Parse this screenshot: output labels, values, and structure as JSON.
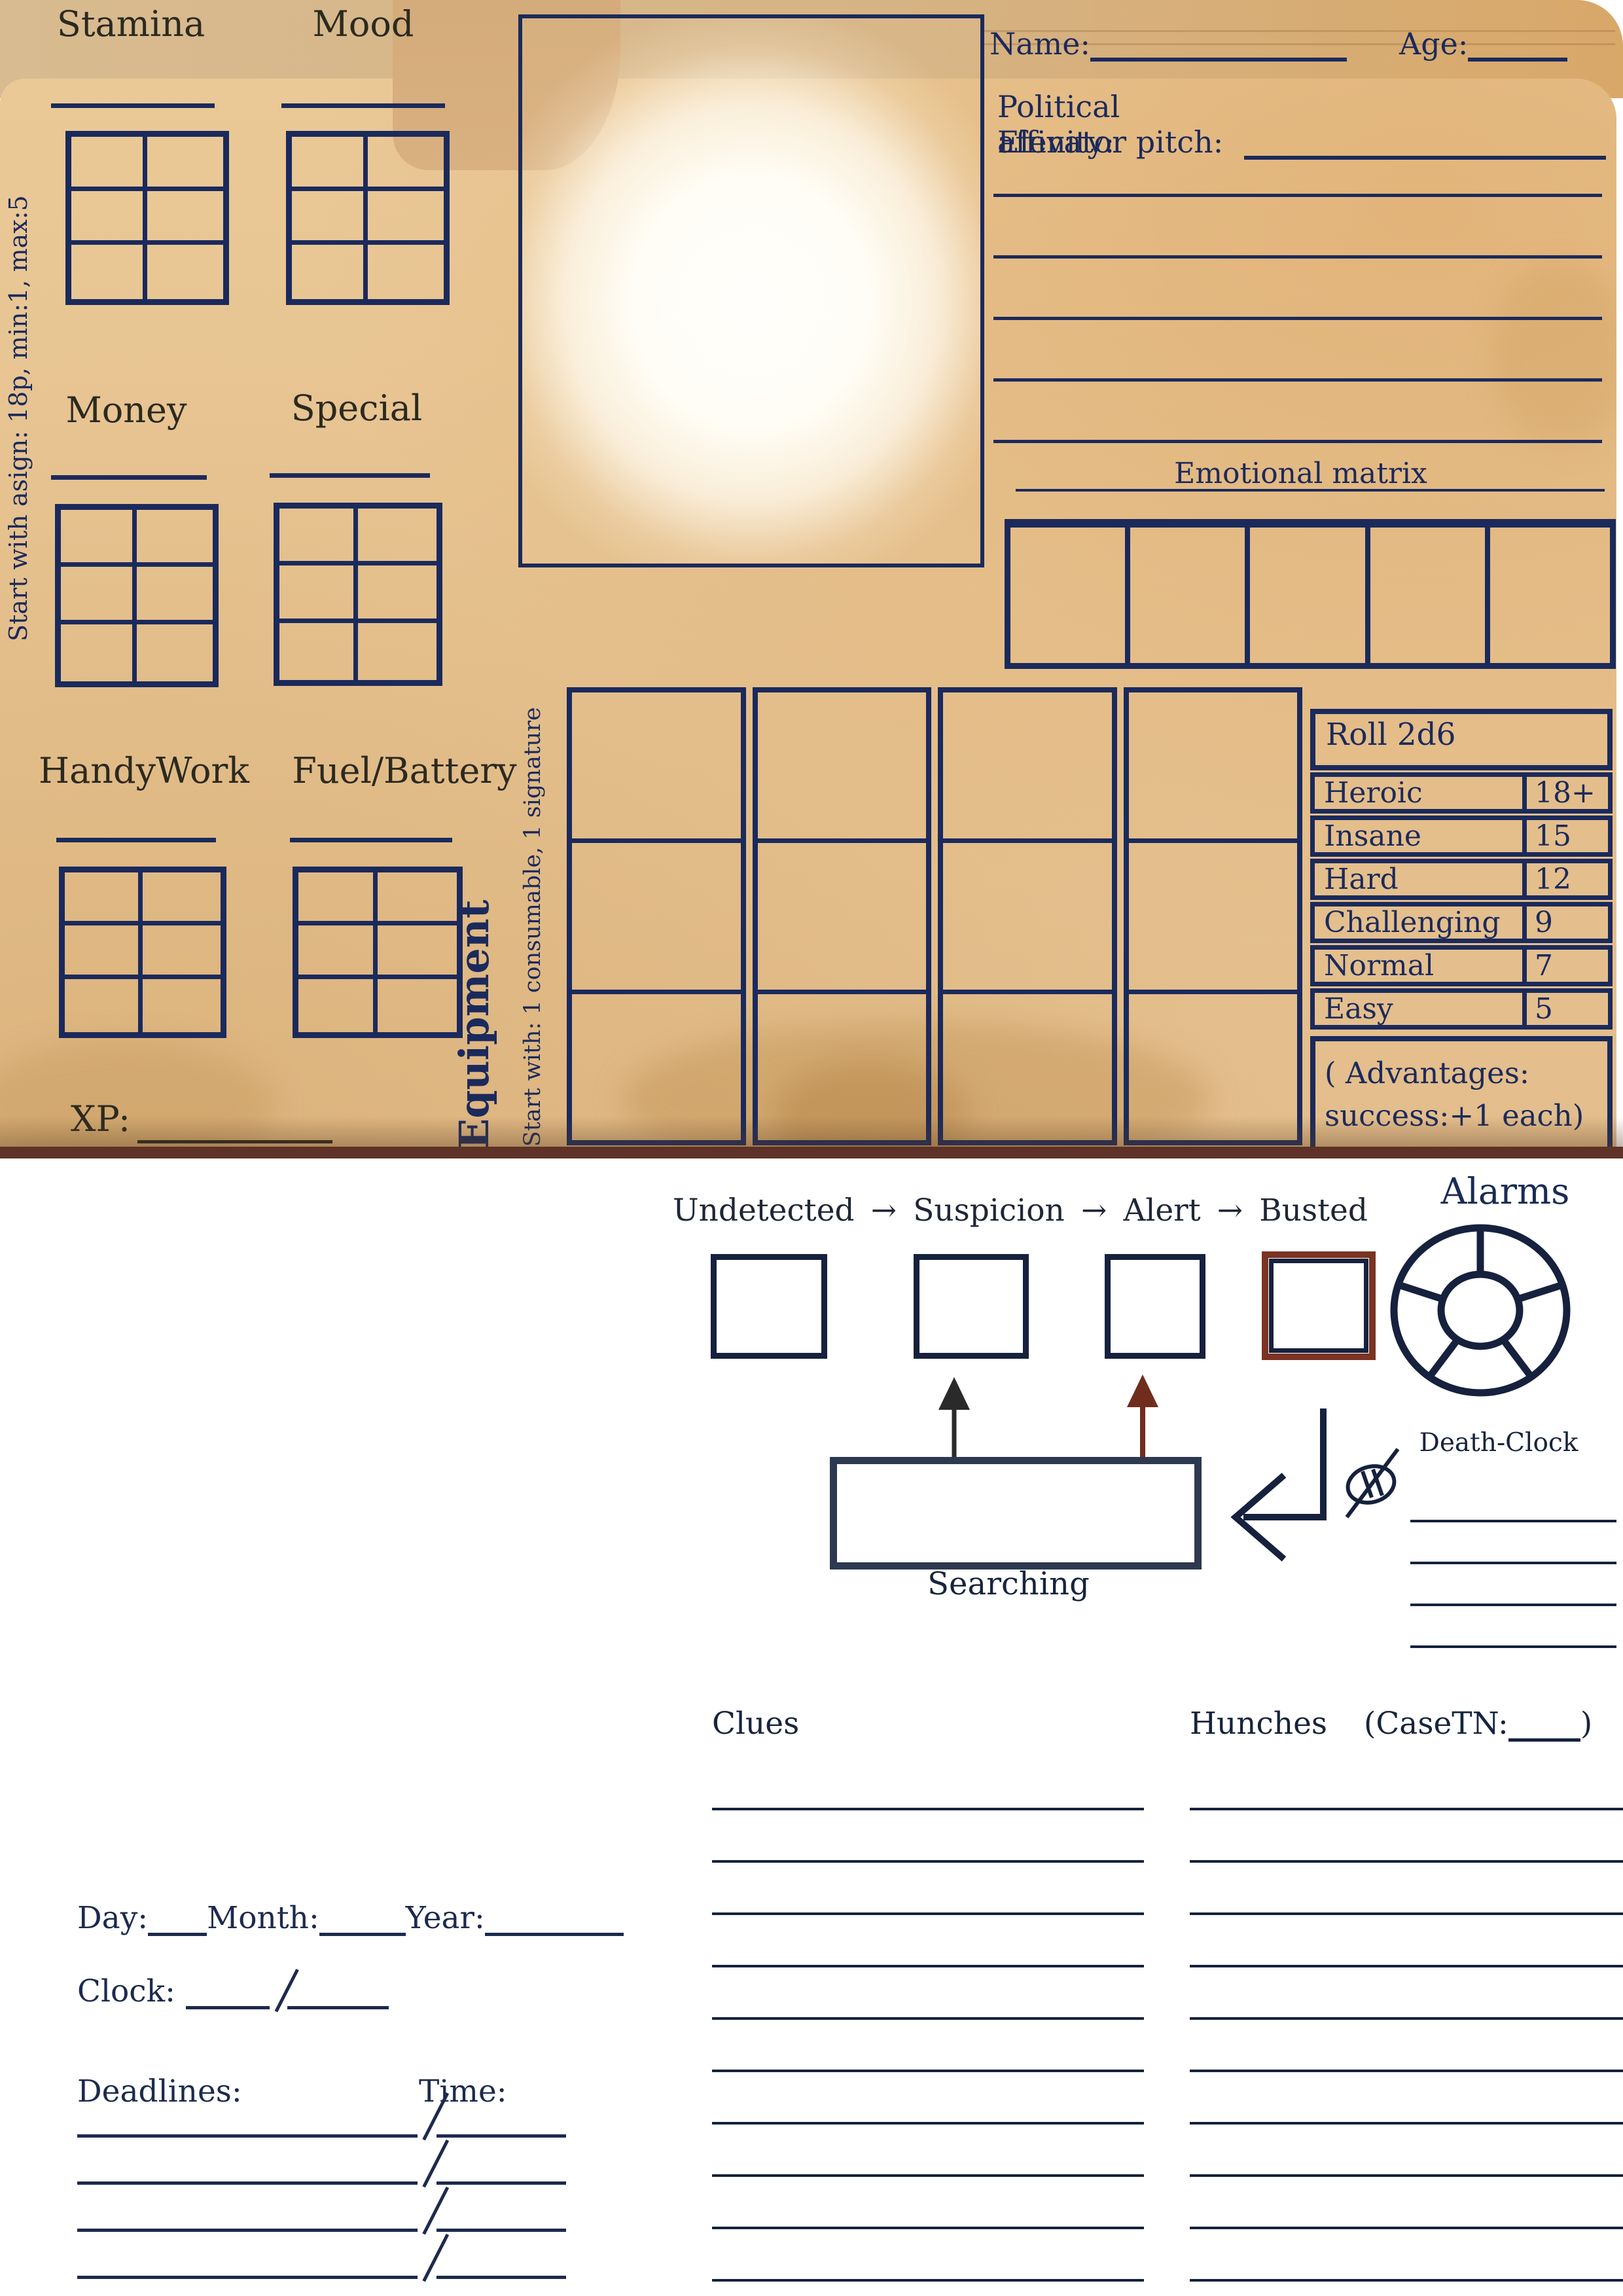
{
  "colors": {
    "navy": "#1b2a5c",
    "ink": "#16213e",
    "paper": "#e8c697",
    "paper_dark": "#d5ac7a",
    "shadow_brown": "#5e3226",
    "busted_brown": "#7b3322",
    "arrow_red": "#6f2d1d",
    "arrow_black": "#2a2a2a",
    "label_black": "#2b2a20"
  },
  "folder": {
    "side_note": "Start with asign: 18p, min:1, max:5",
    "xp_label": "XP:",
    "stats": [
      {
        "label": "Stamina"
      },
      {
        "label": "Mood"
      },
      {
        "label": "Money"
      },
      {
        "label": "Special"
      },
      {
        "label": "HandyWork"
      },
      {
        "label": "Fuel/Battery"
      }
    ],
    "identity": {
      "name_label": "Name:",
      "age_label": "Age:",
      "political_label": "Political affinity:",
      "pitch_label": "Elevator pitch:",
      "emotional_matrix_title": "Emotional matrix"
    },
    "equipment": {
      "title": "Equipment",
      "note": "Start with: 1 consumable, 1 signature"
    },
    "roll_table": {
      "title": "Roll 2d6",
      "rows": [
        {
          "difficulty": "Heroic",
          "target": "18+"
        },
        {
          "difficulty": "Insane",
          "target": "15"
        },
        {
          "difficulty": "Hard",
          "target": "12"
        },
        {
          "difficulty": "Challenging",
          "target": "9"
        },
        {
          "difficulty": "Normal",
          "target": "7"
        },
        {
          "difficulty": "Easy",
          "target": "5"
        }
      ],
      "footer_line1": "( Advantages:",
      "footer_line2": "success:+1 each)"
    }
  },
  "tracker": {
    "stages": [
      "Undetected",
      "Suspicion",
      "Alert",
      "Busted"
    ],
    "arrow_glyph": "→",
    "searching_label": "Searching",
    "alarms_title": "Alarms",
    "death_clock_label": "Death-Clock"
  },
  "case_log": {
    "clues_label": "Clues",
    "hunches_label": "Hunches",
    "case_tn_open": "(CaseTN:",
    "case_tn_close": ")"
  },
  "schedule": {
    "day_label": "Day:",
    "month_label": "Month:",
    "year_label": "Year:",
    "clock_label": "Clock:",
    "deadlines_label": "Deadlines:",
    "time_label": "Time:"
  }
}
